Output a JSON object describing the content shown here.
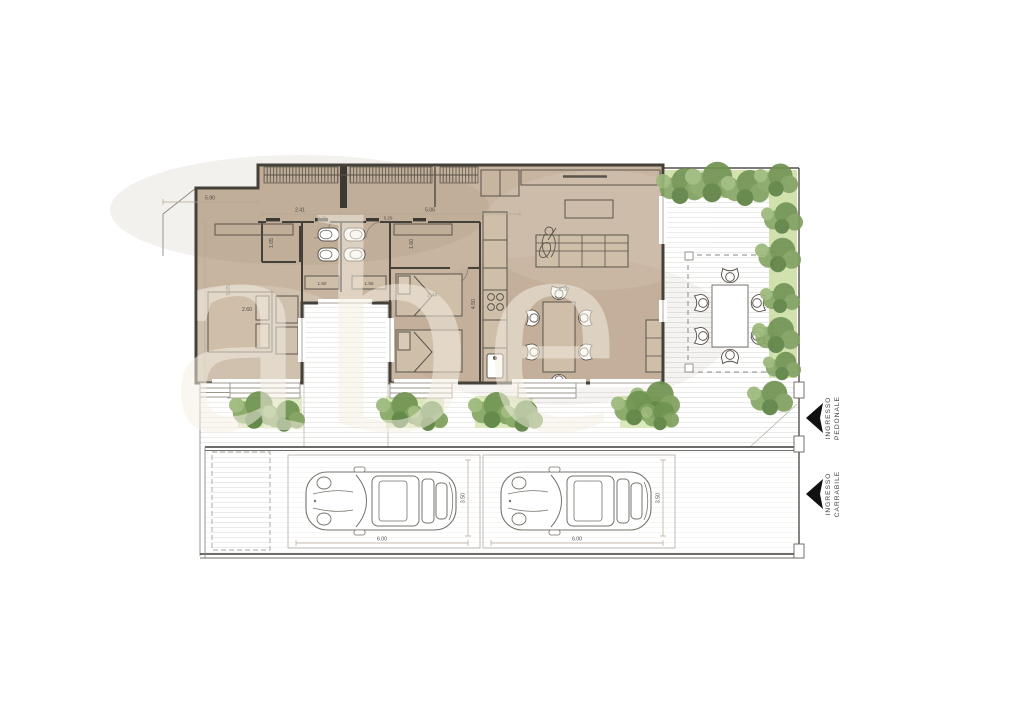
{
  "watermark": {
    "text": "abe",
    "color": "#f6f0e6"
  },
  "entrances": {
    "pedestrian": {
      "line1": "INGRESSO",
      "line2": "PEDONALE"
    },
    "vehicle": {
      "line1": "INGRESSO",
      "line2": "CARRABILE"
    }
  },
  "dims": {
    "top_left": "5.90",
    "corridor_a": "2.41",
    "corridor_b": "5.06",
    "jamb_a": "0.20",
    "jamb_b": "0.20",
    "vanity_a": "1.50",
    "vanity_b": "1.50",
    "closet": "1.05",
    "hall_wardrobe": "1.60",
    "master_height": "5.05",
    "master_bed": "2.60",
    "twin_bed": "2.44",
    "kitchen_run": "4.50",
    "dining": "5.50",
    "stall1_w": "6.00",
    "stall1_d": "3.50",
    "stall2_w": "6.00",
    "stall2_d": "3.50"
  },
  "colors": {
    "floor": "#c8b5a0",
    "wall": "#44403a",
    "furniture_line": "#5a544c",
    "hedge": "#cfe0a8",
    "bush_dark": "#6f9350",
    "bush_mid": "#86a765",
    "planting_bed": "#d8e7b5",
    "site_line": "#8f8b84",
    "arrow": "#111111"
  }
}
